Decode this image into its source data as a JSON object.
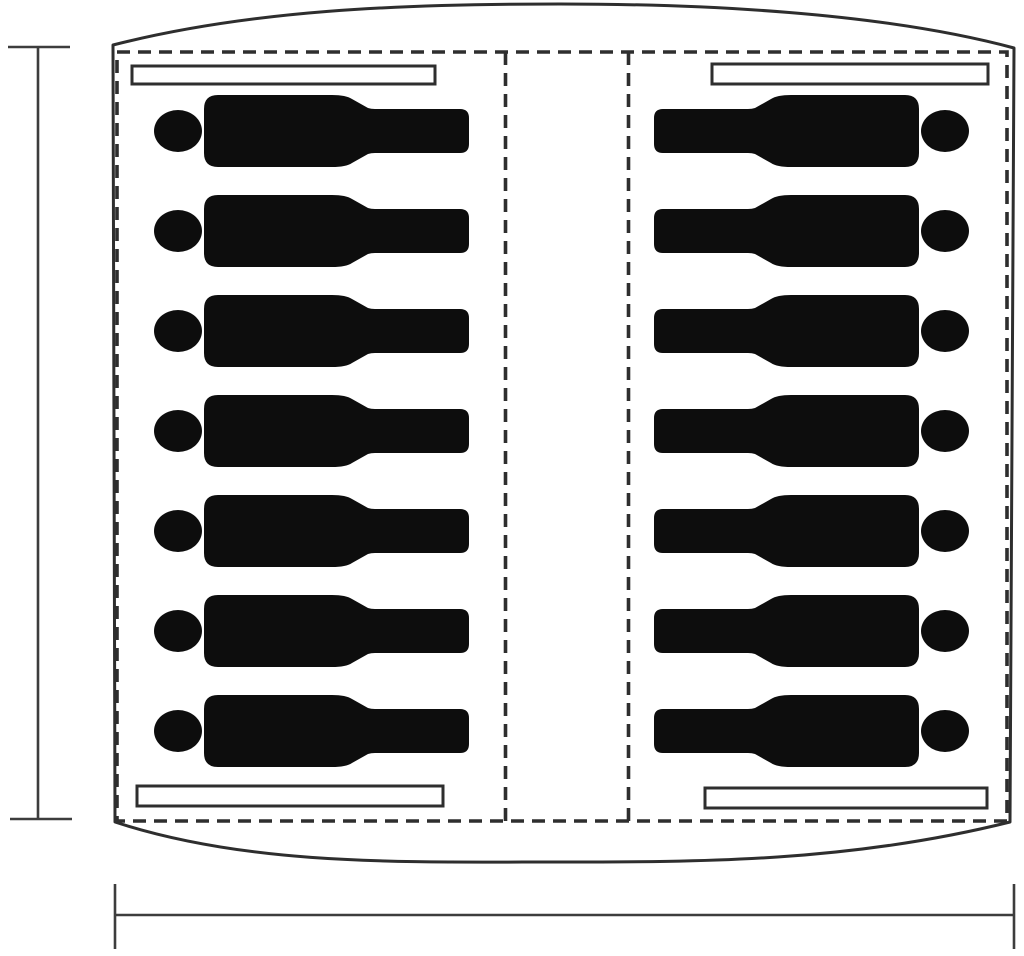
{
  "figure": {
    "type": "connector-pinout-diagram",
    "background": "#ffffff",
    "pin_color": "#0d0d0d",
    "line_color": "#2e2e2e",
    "dimension_line_color": "#3d3d3d",
    "columns": 2,
    "pins_per_column": 7,
    "total_pins": 14,
    "polarizing_bars_per_column": 2,
    "dimension_markers": [
      "left-height-extent",
      "bottom-width-extent"
    ]
  }
}
